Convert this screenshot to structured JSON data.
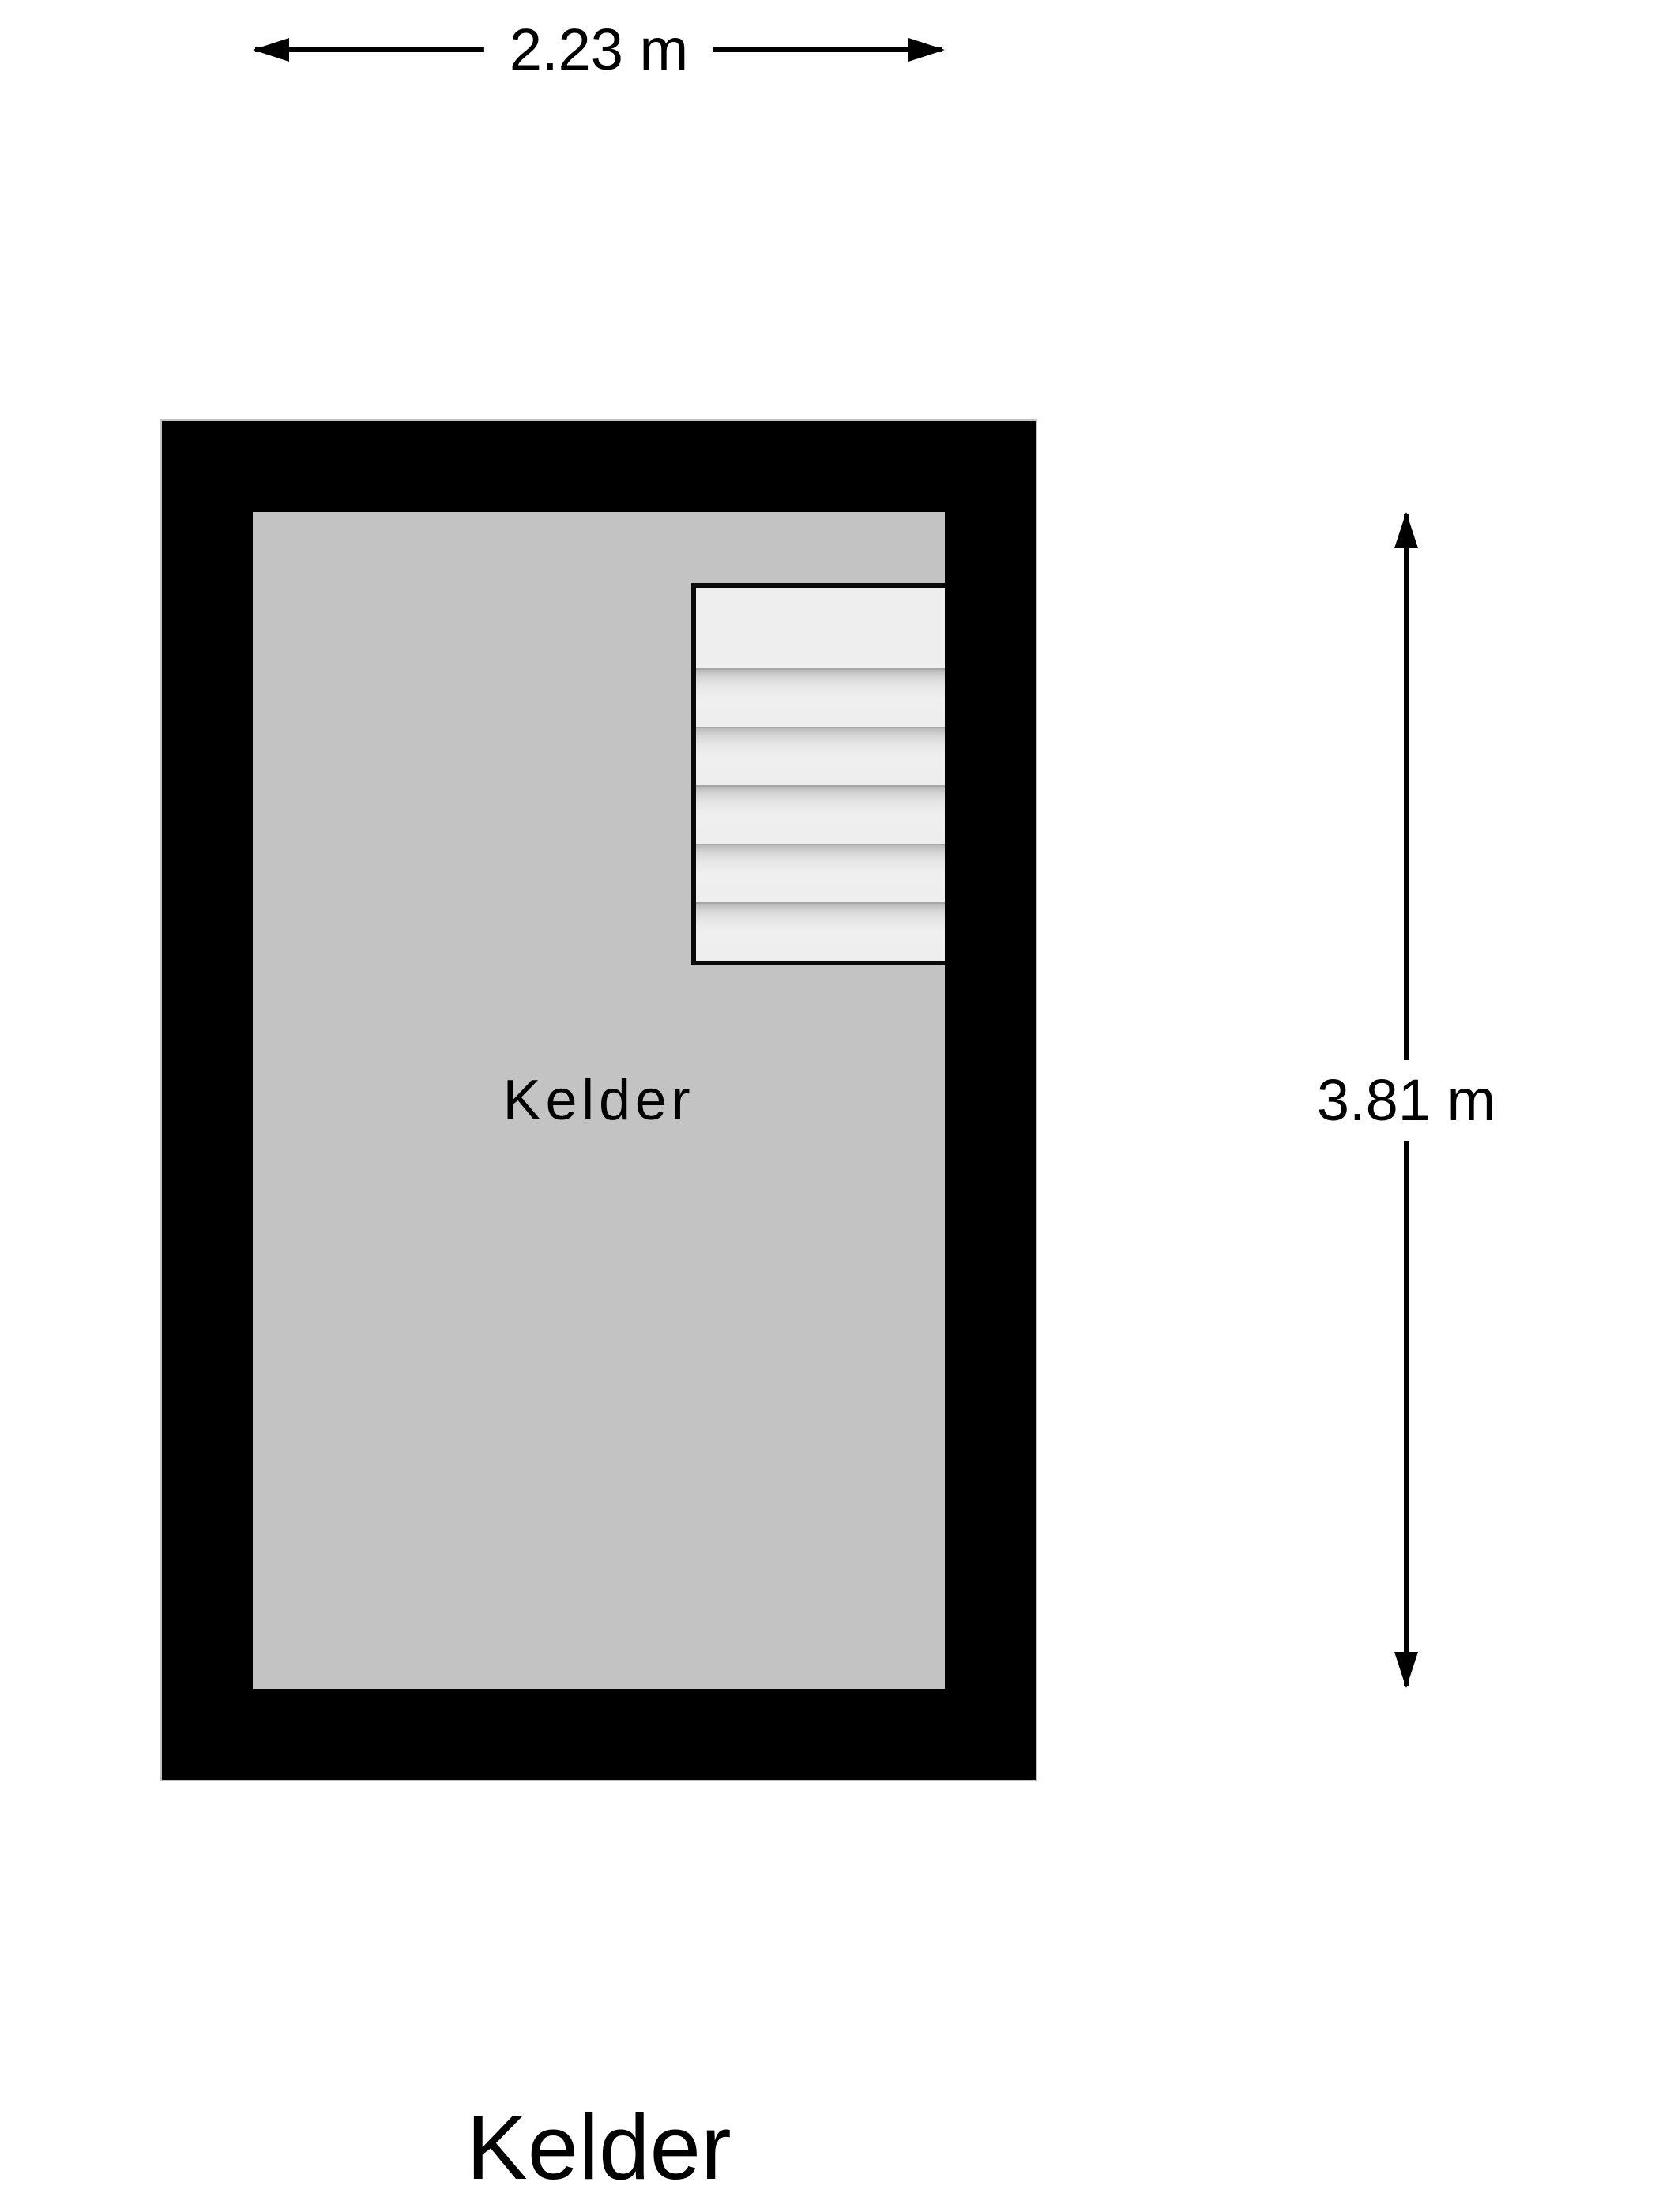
{
  "title": "Kelder",
  "room": {
    "label": "Kelder"
  },
  "dimensions": {
    "width_label": "2.23 m",
    "height_label": "3.81 m"
  },
  "stairs": {
    "steps": 6
  },
  "colors": {
    "bg": "#ffffff",
    "wall": "#000000",
    "floor": "#c3c3c3",
    "stairs": "#eeeeee",
    "ink": "#000000"
  }
}
